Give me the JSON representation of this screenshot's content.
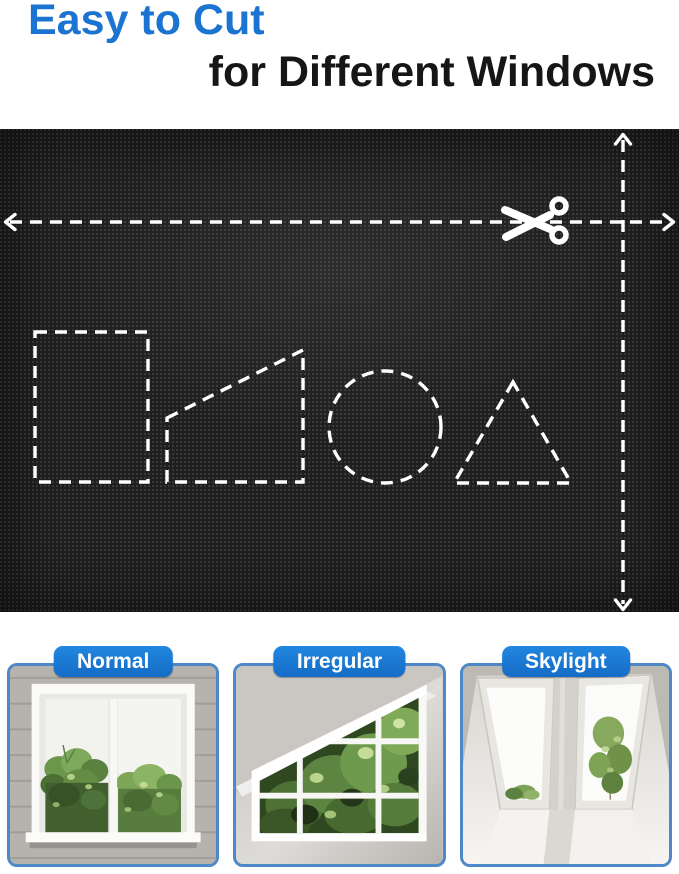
{
  "title": {
    "line1": "Easy to Cut",
    "line2": "for Different Windows"
  },
  "colors": {
    "title_blue": "#1b74d2",
    "title_black": "#161616",
    "pill_blue": "#1877d2",
    "card_border_blue": "#4d89c9",
    "fabric_base": "#1e1e1e",
    "dash_lines": "#ffffff"
  },
  "fabric_panel": {
    "icon": "scissors-icon",
    "cut_lines": [
      {
        "name": "horizontal-cut-line",
        "arrows": "left-and-right"
      },
      {
        "name": "vertical-cut-line",
        "arrows": "up-and-down"
      }
    ],
    "cut_shapes": [
      "rectangle",
      "trapezoid",
      "circle",
      "triangle"
    ]
  },
  "window_cards": [
    {
      "label": "Normal"
    },
    {
      "label": "Irregular"
    },
    {
      "label": "Skylight"
    }
  ]
}
